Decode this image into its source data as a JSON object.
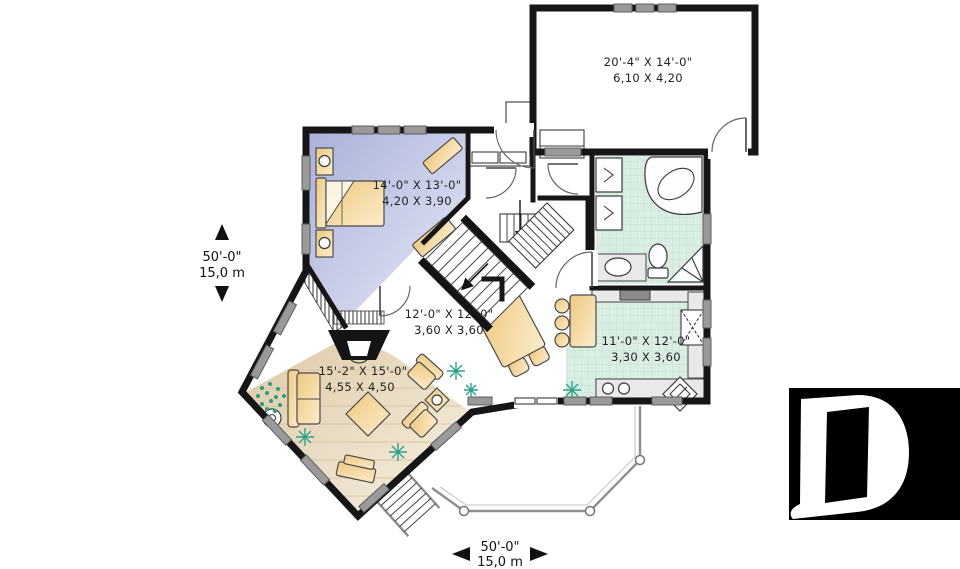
{
  "plan": {
    "rooms": {
      "garage": {
        "feet": "20'-4\" X 14'-0\"",
        "meters": "6,10 X 4,20"
      },
      "bedroom": {
        "feet": "14'-0\" X 13'-0\"",
        "meters": "4,20 X 3,90"
      },
      "dining": {
        "feet": "12'-0\" X 12'-0\"",
        "meters": "3,60 X 3,60"
      },
      "kitchen": {
        "feet": "11'-0\" X 12'-0\"",
        "meters": "3,30 X 3,60"
      },
      "living": {
        "feet": "15'-2\" X 15'-0\"",
        "meters": "4,55 X 4,50"
      }
    },
    "dimensions": {
      "vertical": {
        "feet": "50'-0\"",
        "meters": "15,0 m"
      },
      "horizontal": {
        "feet": "50'-0\"",
        "meters": "15,0 m"
      }
    },
    "colors": {
      "wall": "#161616",
      "bedroom_floor": "#c3c8e6",
      "tile_floor": "#daeee4",
      "living_floor": "#e7d8bd",
      "furniture": "#f3d9a2",
      "window": "#9a9a9a",
      "deck_rail": "#8f8f8f",
      "plant": "#2fa08c",
      "logo_bg": "#000000",
      "logo_fg": "#ffffff"
    }
  }
}
